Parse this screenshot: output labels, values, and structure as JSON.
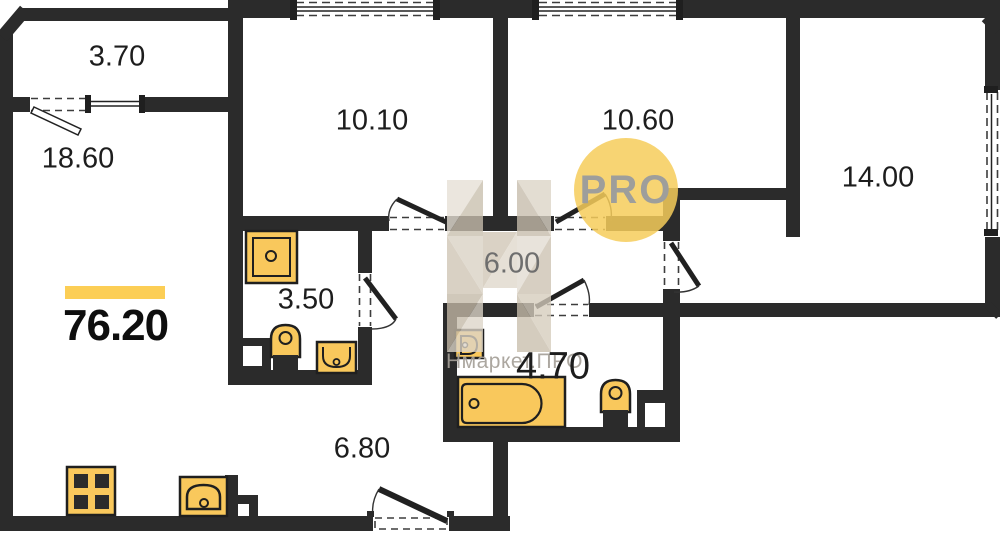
{
  "plan": {
    "total_area": {
      "value": "76.20"
    },
    "rooms": [
      {
        "id": "balcony",
        "area": "3.70"
      },
      {
        "id": "living-room",
        "area": "18.60"
      },
      {
        "id": "bedroom-top-center",
        "area": "10.10"
      },
      {
        "id": "bedroom-top-right",
        "area": "10.60"
      },
      {
        "id": "bedroom-right",
        "area": "14.00"
      },
      {
        "id": "hallway",
        "area": "6.00"
      },
      {
        "id": "bathroom-small",
        "area": "3.50"
      },
      {
        "id": "bathroom-large",
        "area": "4.70"
      },
      {
        "id": "corridor",
        "area": "6.80"
      }
    ],
    "watermark": {
      "circle_text": "PRO",
      "brand_text": "Нмаркет.ПРО"
    },
    "colors": {
      "wall": "#2b2b2b",
      "fixture_fill": "#f9c85c",
      "accent_bar": "#fcce55",
      "watermark_circle": "#f6cd5a",
      "watermark_beige": "#d5ccbc"
    }
  }
}
